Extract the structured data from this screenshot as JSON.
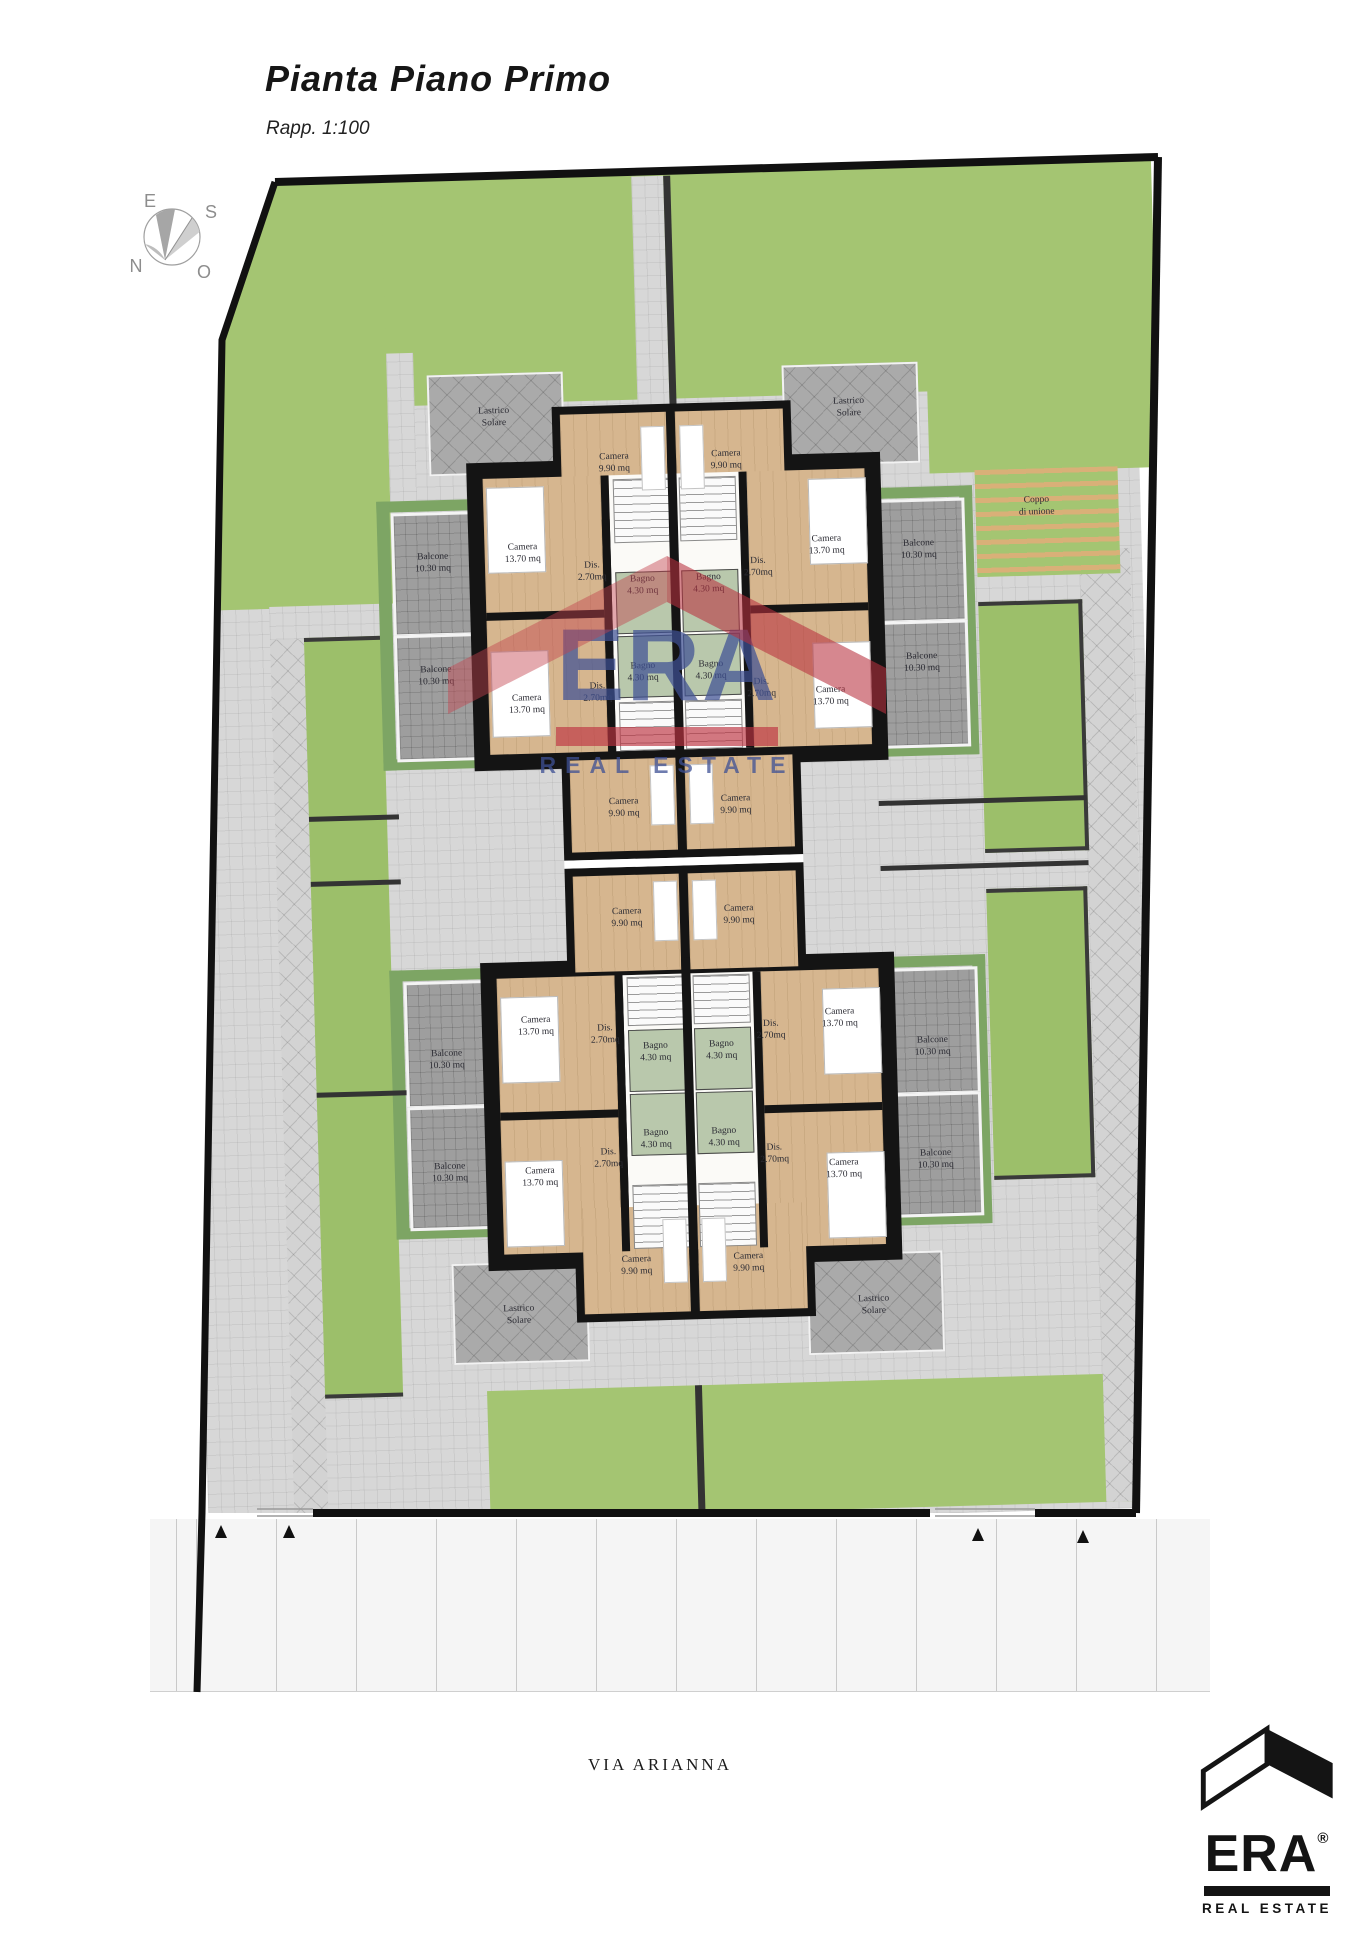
{
  "header": {
    "title": "Pianta Piano Primo",
    "scale": "Rapp. 1:100"
  },
  "compass": {
    "n": "N",
    "s": "S",
    "e": "E",
    "o": "O"
  },
  "rooms": {
    "camera_small": {
      "name": "Camera",
      "area": "9.90 mq"
    },
    "camera_large": {
      "name": "Camera",
      "area": "13.70 mq"
    },
    "balcone": {
      "name": "Balcone",
      "area": "10.30 mq"
    },
    "bagno": {
      "name": "Bagno",
      "area": "4.30 mq"
    },
    "dis": {
      "name": "Dis.",
      "area": "2.70mq"
    },
    "lastrico": {
      "name": "Lastrico",
      "area": "Solare"
    }
  },
  "site": {
    "pergola_line1": "Coppo",
    "pergola_line2": "di unione"
  },
  "street": {
    "label": "VIA ARIANNA"
  },
  "watermark": {
    "brand": "ERA",
    "tagline": "REAL ESTATE"
  },
  "logo": {
    "brand": "ERA",
    "registered": "®",
    "tagline": "REAL ESTATE"
  },
  "colors": {
    "grass": "#a4c572",
    "paving": "#d7d7d7",
    "wood": "#d6b68f",
    "bath": "#b9c8ac",
    "wall": "#141414",
    "watermark_red": "#be3442",
    "watermark_blue": "#3e5094"
  }
}
